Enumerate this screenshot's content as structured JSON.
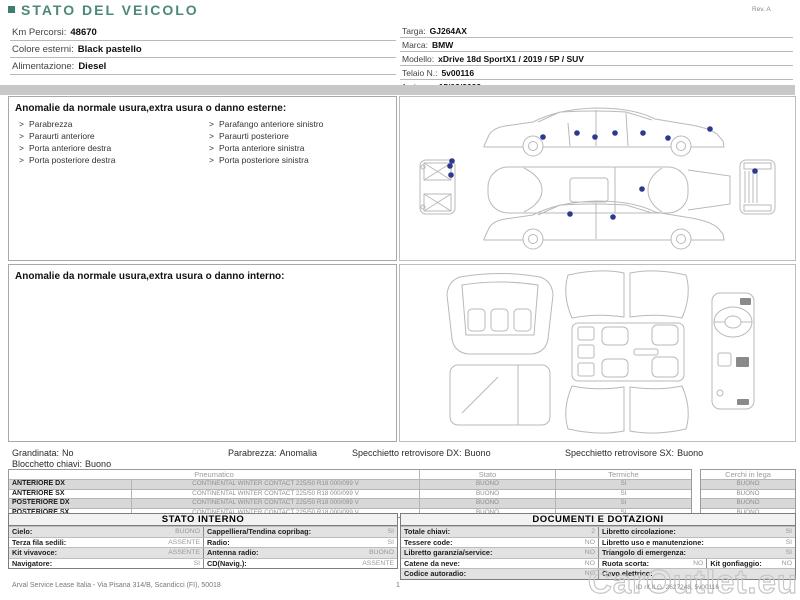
{
  "colors": {
    "title_accent": "#4c897b",
    "damage_marker": "#2b3990",
    "row_stripe": "#d8d8d8"
  },
  "header": {
    "title": "STATO DEL VEICOLO",
    "revision": "Rev. A"
  },
  "vehicle_info": {
    "left": [
      {
        "label": "Km Percorsi:",
        "value": "48670"
      },
      {
        "label": "Colore esterni:",
        "value": "Black pastello"
      },
      {
        "label": "Alimentazione:",
        "value": "Diesel"
      }
    ],
    "right": [
      {
        "label": "Targa:",
        "value": "GJ264AX"
      },
      {
        "label": "Marca:",
        "value": "BMW"
      },
      {
        "label": "Modello:",
        "value": "xDrive 18d SportX1 / 2019 / 5P / SUV"
      },
      {
        "label": "Telaio N.:",
        "value": "5v00116"
      },
      {
        "label": "1a imm.:",
        "value": "15/02/2022"
      }
    ]
  },
  "exterior_anomalies": {
    "header": "Anomalie da normale usura,extra usura o danno esterne:",
    "bullet": ">",
    "items_left": [
      "Parabrezza",
      "Paraurti anteriore",
      "Porta anteriore destra",
      "Porta posteriore destra"
    ],
    "items_right": [
      "Parafango anteriore sinistro",
      "Paraurti posteriore",
      "Porta anteriore sinistra",
      "Porta posteriore sinistra"
    ]
  },
  "interior_anomalies": {
    "header": "Anomalie da normale usura,extra usura o danno interno:"
  },
  "condition_summary": [
    {
      "label": "Grandinata:",
      "value": "No"
    },
    {
      "label": "Parabrezza:",
      "value": "Anomalia"
    },
    {
      "label": "Specchietto retrovisore DX:",
      "value": "Buono"
    },
    {
      "label": "Specchietto retrovisore SX:",
      "value": "Buono"
    },
    {
      "label": "Blocchetto chiavi:",
      "value": "Buono"
    }
  ],
  "tyres": {
    "headers": {
      "pneumatico": "Pneumatico",
      "stato": "Stato",
      "termiche": "Termiche",
      "cerchi": "Cerchi in lega"
    },
    "rows": [
      {
        "position": "ANTERIORE DX",
        "tyre": "CONTINENTAL WINTER CONTACT 225/50 R18 000/099 V",
        "stato": "BUONO",
        "termiche": "SI",
        "cerchi": "BUONO"
      },
      {
        "position": "ANTERIORE SX",
        "tyre": "CONTINENTAL WINTER CONTACT 225/50 R18 000/099 V",
        "stato": "BUONO",
        "termiche": "SI",
        "cerchi": "BUONO"
      },
      {
        "position": "POSTERIORE DX",
        "tyre": "CONTINENTAL WINTER CONTACT 225/50 R18 000/099 V",
        "stato": "BUONO",
        "termiche": "SI",
        "cerchi": "BUONO"
      },
      {
        "position": "POSTERIORE SX",
        "tyre": "CONTINENTAL WINTER CONTACT 225/50 R18 000/099 V",
        "stato": "BUONO",
        "termiche": "SI",
        "cerchi": "BUONO"
      }
    ]
  },
  "stato_interno": {
    "title": "STATO INTERNO",
    "rows": [
      {
        "l1": "Cielo:",
        "v1": "BUONO",
        "l2": "Cappelliera/Tendina copribag:",
        "v2": "SI"
      },
      {
        "l1": "Terza fila sedili:",
        "v1": "ASSENTE",
        "l2": "Radio:",
        "v2": "SI"
      },
      {
        "l1": "Kit vivavoce:",
        "v1": "ASSENTE",
        "l2": "Antenna radio:",
        "v2": "BUONO"
      },
      {
        "l1": "Navigatore:",
        "v1": "SI",
        "l2": "CD(Navig.):",
        "v2": "ASSENTE"
      }
    ]
  },
  "documenti": {
    "title": "DOCUMENTI E DOTAZIONI",
    "rows": [
      {
        "l1": "Totale chiavi:",
        "v1": "2",
        "l2": "Libretto circolazione:",
        "v2": "SI"
      },
      {
        "l1": "Tessere code:",
        "v1": "NO",
        "l2": "Libretto uso e manutenzione:",
        "v2": "SI"
      },
      {
        "l1": "Libretto garanzia/service:",
        "v1": "NO",
        "l2": "Triangolo di emergenza:",
        "v2": "SI"
      },
      {
        "l1": "Catene da neve:",
        "v1": "NO",
        "l2": "Ruota scorta:",
        "v2": "NO",
        "l3": "Kit gonfiaggio:",
        "v3": "NO"
      },
      {
        "l1": "Codice autoradio:",
        "v1": "NO",
        "l2": "Cavo elettrico:",
        "v2": ""
      }
    ]
  },
  "footer": {
    "company": "Arval Service Lease Italia - Via Pisana 314/B, Scandicci (FI), 50018",
    "page_number": "1",
    "watermark": "CarOutlet.eu",
    "watermark_id": "ID rif.ILG. 2627248, 5v00116"
  }
}
